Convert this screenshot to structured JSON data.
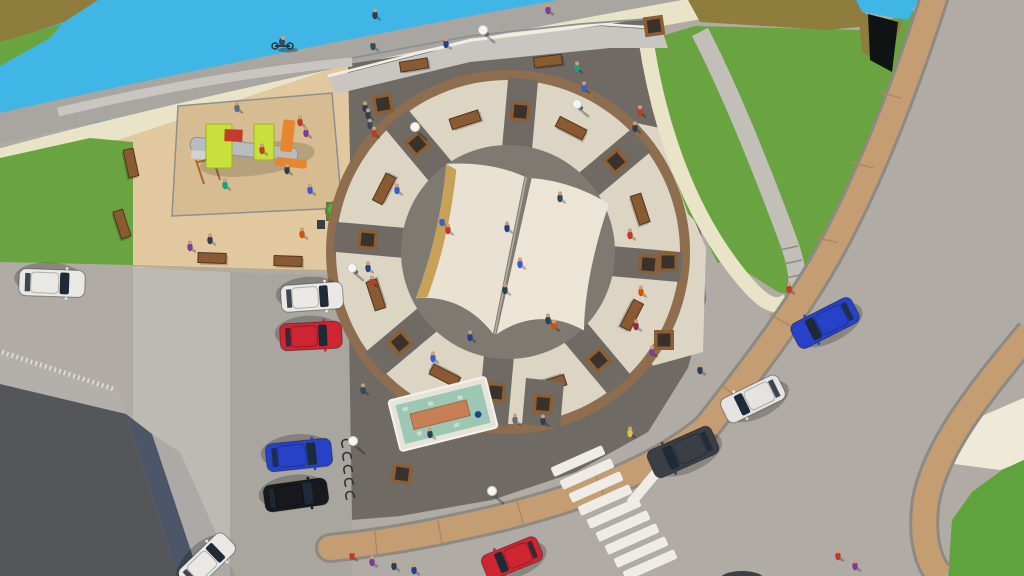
{
  "scene": {
    "description": "Aerial 3D architectural rendering of a circular public plaza featuring a giant open-book monument at its center, surrounded by a beige ring walkway with benches and planters, an upper terrace with railing, a riverside promenade with cyclist, an airplane-shaped playground on sand, green slopes with curved ramp paths, a fountain pool, street parking with cars, and a road with a zebra crossing",
    "render_style": "3d-visualization",
    "view": "bird's-eye"
  },
  "palette": {
    "road": "#b0aba5",
    "parkingLight": "#bdb9b3",
    "parkingDark": "#a9a59f",
    "water": "#3fb6e6",
    "olive": "#8f7d3e",
    "oliveDark": "#6e5f2c",
    "grass": "#69a441",
    "grassDark": "#5ea33b",
    "sand": "#e2c89e",
    "sandPlay": "#d7bc92",
    "cream": "#e9e4c8",
    "pathGray": "#a9a6a2",
    "rampGray": "#c2bfb9",
    "wall": "#c9c6c2",
    "wallEdge": "#efeee9",
    "plazaDark": "#6f6b64",
    "plazaInner": "#7e7a72",
    "ringBeige": "#ddd5c3",
    "ringBrown": "#8f6e4f",
    "spoke": "#6f6b64",
    "planterBrown": "#8a5f38",
    "planterDark": "#3a322a",
    "benchWood": "#8a5a33",
    "benchEdge": "#4f371d",
    "sidewalkTan": "#c49d72",
    "curb": "#8d8983",
    "joint": "#ab8a60",
    "buildingRoof": "#55565a",
    "buildingSlope": "#4c5668",
    "buildingWall": "#b3b0ab",
    "tactile": "#dcd9d4",
    "bookPageLeft": "#e9e2d3",
    "bookPageRight": "#ece5d6",
    "bookGold": "#c8a159",
    "bookSpine": "#b5ad9c",
    "fountainRim": "#e6e3d8",
    "fountainWater": "#9cc7b4",
    "fountainAccent": "#c67f56",
    "zebraWhite": "#efece7",
    "structureBlack": "#101314",
    "glass": "#1e2a38",
    "treeGreen": "#4e8f37",
    "treeLight": "#66a845",
    "railDark": "#3f434a",
    "railLight": "#d8d9da",
    "skin": "#c9a07b",
    "shadow": "rgba(0,0,0,0.25)"
  },
  "ring": {
    "cx": 508,
    "cy": 252,
    "outerR": 182,
    "beigeR": 172,
    "innerR": 107,
    "spokeWidth": 30,
    "spokeAngles": [
      5,
      50,
      95,
      140,
      185,
      230,
      275,
      320
    ],
    "benchAngles": [
      27,
      72,
      117,
      162,
      207,
      252,
      297,
      342
    ],
    "planterRadius": 141,
    "benchRadius": 139
  },
  "book": {
    "cx": 512,
    "cy": 253,
    "rotation": 12,
    "scale": 0.92
  },
  "cars": [
    {
      "x": 52,
      "y": 283,
      "rot": 182,
      "color": "#e9e8e4",
      "len": 66,
      "wid": 27,
      "kind": "white-car"
    },
    {
      "x": 312,
      "y": 297,
      "rot": 176,
      "color": "#e9e8e4",
      "len": 62,
      "wid": 27,
      "kind": "white-car"
    },
    {
      "x": 311,
      "y": 336,
      "rot": 177,
      "color": "#cf2431",
      "len": 62,
      "wid": 27,
      "kind": "red-car"
    },
    {
      "x": 299,
      "y": 455,
      "rot": 174,
      "color": "#2742c8",
      "len": 66,
      "wid": 28,
      "kind": "blue-car"
    },
    {
      "x": 296,
      "y": 495,
      "rot": 172,
      "color": "#17191d",
      "len": 64,
      "wid": 27,
      "kind": "black-car"
    },
    {
      "x": 207,
      "y": 561,
      "rot": 136,
      "color": "#e9e8e4",
      "len": 62,
      "wid": 26,
      "kind": "white-car"
    },
    {
      "x": 512,
      "y": 558,
      "rot": -22,
      "color": "#cf2431",
      "len": 60,
      "wid": 26,
      "kind": "red-car"
    },
    {
      "x": 683,
      "y": 452,
      "rot": -24,
      "color": "#3a3f45",
      "len": 70,
      "wid": 30,
      "kind": "dark-van"
    },
    {
      "x": 753,
      "y": 399,
      "rot": -26,
      "color": "#e4e3df",
      "len": 64,
      "wid": 27,
      "kind": "white-car"
    },
    {
      "x": 825,
      "y": 323,
      "rot": -27,
      "color": "#2742c8",
      "len": 68,
      "wid": 28,
      "kind": "blue-car"
    }
  ],
  "people": [
    {
      "x": 375,
      "y": 15,
      "c": "#2c3e50"
    },
    {
      "x": 548,
      "y": 10,
      "c": "#7d3c98"
    },
    {
      "x": 373,
      "y": 46,
      "c": "#34495e"
    },
    {
      "x": 446,
      "y": 44,
      "c": "#27408b"
    },
    {
      "x": 577,
      "y": 68,
      "c": "#16a085"
    },
    {
      "x": 584,
      "y": 88,
      "c": "#3b5bd6"
    },
    {
      "x": 640,
      "y": 112,
      "c": "#c0392b"
    },
    {
      "x": 635,
      "y": 128,
      "c": "#2c3e50"
    },
    {
      "x": 365,
      "y": 108,
      "c": "#2c3e50"
    },
    {
      "x": 370,
      "y": 125,
      "c": "#34495e"
    },
    {
      "x": 300,
      "y": 122,
      "c": "#c0392b"
    },
    {
      "x": 306,
      "y": 133,
      "c": "#7d3c98"
    },
    {
      "x": 368,
      "y": 115,
      "c": "#2c3e50"
    },
    {
      "x": 374,
      "y": 133,
      "c": "#c0392b"
    },
    {
      "x": 397,
      "y": 190,
      "c": "#3b5bd6"
    },
    {
      "x": 210,
      "y": 240,
      "c": "#2c3e50"
    },
    {
      "x": 302,
      "y": 234,
      "c": "#d35400"
    },
    {
      "x": 190,
      "y": 247,
      "c": "#7d3c98"
    },
    {
      "x": 237,
      "y": 108,
      "c": "#5d6d7e"
    },
    {
      "x": 262,
      "y": 150,
      "c": "#c43b2a"
    },
    {
      "x": 287,
      "y": 170,
      "c": "#2c3e50"
    },
    {
      "x": 225,
      "y": 185,
      "c": "#16a085"
    },
    {
      "x": 310,
      "y": 190,
      "c": "#3b5bd6"
    },
    {
      "x": 630,
      "y": 235,
      "c": "#c0392b"
    },
    {
      "x": 641,
      "y": 292,
      "c": "#d35400"
    },
    {
      "x": 636,
      "y": 326,
      "c": "#922b3e"
    },
    {
      "x": 652,
      "y": 352,
      "c": "#7d3c98"
    },
    {
      "x": 507,
      "y": 228,
      "c": "#27408b"
    },
    {
      "x": 520,
      "y": 264,
      "c": "#3b5bd6"
    },
    {
      "x": 505,
      "y": 290,
      "c": "#2c3e50"
    },
    {
      "x": 560,
      "y": 198,
      "c": "#34495e"
    },
    {
      "x": 442,
      "y": 222,
      "c": "#3b5bd6"
    },
    {
      "x": 448,
      "y": 230,
      "c": "#c0392b"
    },
    {
      "x": 548,
      "y": 320,
      "c": "#2c3e50"
    },
    {
      "x": 554,
      "y": 326,
      "c": "#d35400"
    },
    {
      "x": 470,
      "y": 337,
      "c": "#27408b"
    },
    {
      "x": 368,
      "y": 268,
      "c": "#27408b"
    },
    {
      "x": 372,
      "y": 282,
      "c": "#c0392b"
    },
    {
      "x": 433,
      "y": 358,
      "c": "#3b5bd6"
    },
    {
      "x": 515,
      "y": 420,
      "c": "#5d6d7e"
    },
    {
      "x": 543,
      "y": 421,
      "c": "#2c3e50"
    },
    {
      "x": 363,
      "y": 390,
      "c": "#34495e"
    },
    {
      "x": 430,
      "y": 434,
      "c": "#2c3e50"
    },
    {
      "x": 789,
      "y": 289,
      "c": "#c0392b"
    },
    {
      "x": 700,
      "y": 370,
      "c": "#2c3e50"
    },
    {
      "x": 630,
      "y": 433,
      "c": "#d4c34a"
    },
    {
      "x": 352,
      "y": 556,
      "c": "#c0392b"
    },
    {
      "x": 372,
      "y": 562,
      "c": "#7d3c98"
    },
    {
      "x": 394,
      "y": 566,
      "c": "#2c3e50"
    },
    {
      "x": 414,
      "y": 570,
      "c": "#27408b"
    },
    {
      "x": 838,
      "y": 556,
      "c": "#c0392b"
    },
    {
      "x": 855,
      "y": 566,
      "c": "#7d3c98"
    }
  ],
  "benches": [
    {
      "x": 414,
      "y": 65,
      "rot": -9
    },
    {
      "x": 548,
      "y": 61,
      "rot": -7
    },
    {
      "x": 212,
      "y": 258,
      "rot": 2
    },
    {
      "x": 288,
      "y": 261,
      "rot": 2
    },
    {
      "x": 131,
      "y": 163,
      "rot": 78
    },
    {
      "x": 122,
      "y": 224,
      "rot": 72
    }
  ],
  "lamps": [
    {
      "x": 483,
      "y": 30
    },
    {
      "x": 577,
      "y": 104
    },
    {
      "x": 415,
      "y": 127
    },
    {
      "x": 352,
      "y": 268
    },
    {
      "x": 353,
      "y": 441
    },
    {
      "x": 492,
      "y": 491
    }
  ],
  "planters": [
    {
      "x": 383,
      "y": 104,
      "rot": -10
    },
    {
      "x": 654,
      "y": 26,
      "rot": -8
    },
    {
      "x": 402,
      "y": 474,
      "rot": 8
    },
    {
      "x": 543,
      "y": 404,
      "rot": 4
    },
    {
      "x": 668,
      "y": 262,
      "rot": 0
    },
    {
      "x": 664,
      "y": 340,
      "rot": 0
    }
  ],
  "bike_racks": {
    "x": 346,
    "y_start": 444,
    "step": 13,
    "count": 5
  },
  "zebra": {
    "start_x": 578,
    "start_y": 461,
    "step_x": 9,
    "step_y": 13,
    "count": 9,
    "len": 56,
    "wid": 10,
    "rot": -24
  },
  "stop_bar": {
    "x": 651,
    "y": 479,
    "len": 64,
    "wid": 10,
    "rot": -50
  }
}
